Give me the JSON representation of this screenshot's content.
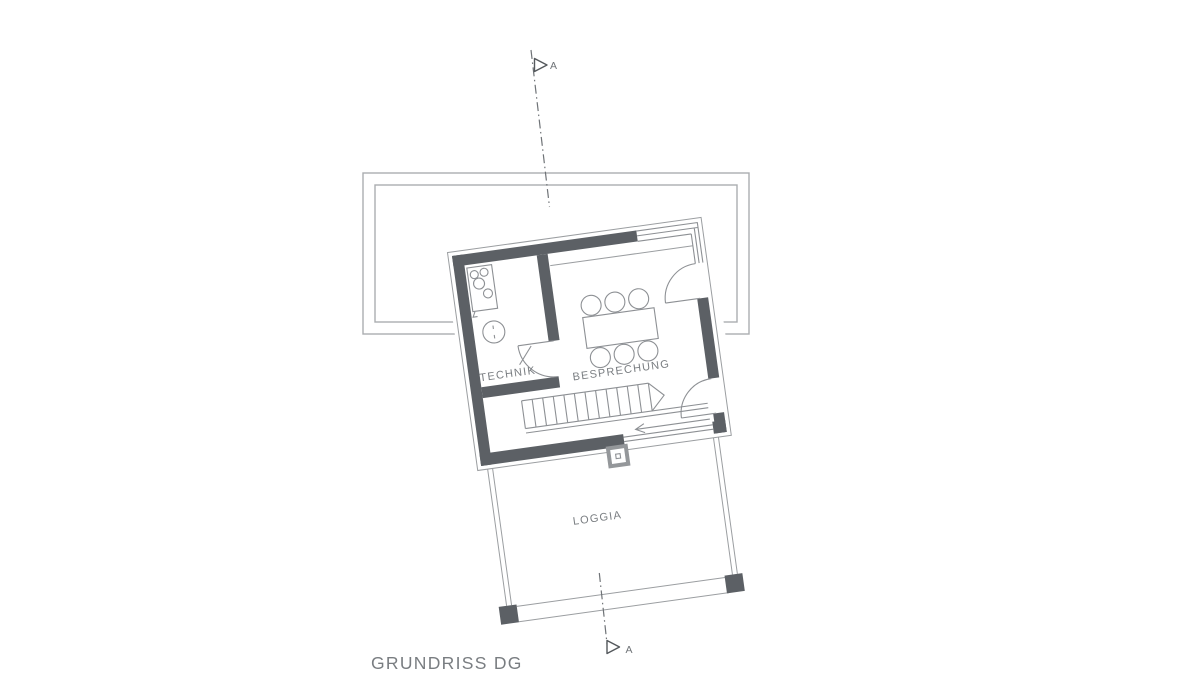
{
  "drawing": {
    "title": "GRUNDRISS DG"
  },
  "rooms": {
    "technik": "TECHNIK",
    "besprechung": "BESPRECHUNG",
    "loggia": "LOGGIA"
  },
  "section_markers": {
    "top": "A",
    "bottom": "A"
  },
  "icons": {
    "stairs": "stairs-symbol",
    "stair_direction": "arrow-left",
    "meeting_table": "table-with-six-chairs",
    "kitchen": "kitchen-sink-unit",
    "boiler": "boiler-circle",
    "chimney": "chimney-square",
    "doors": "door-swing-arc",
    "section_marker": "section-cut-triangle"
  },
  "colors": {
    "background": "#ffffff",
    "wall": "#5c6065",
    "thin_line": "#8d9094",
    "light_line": "#9b9ea1",
    "roof_outline": "#abadb0",
    "text": "#797d81",
    "section_line": "#6f7377"
  }
}
